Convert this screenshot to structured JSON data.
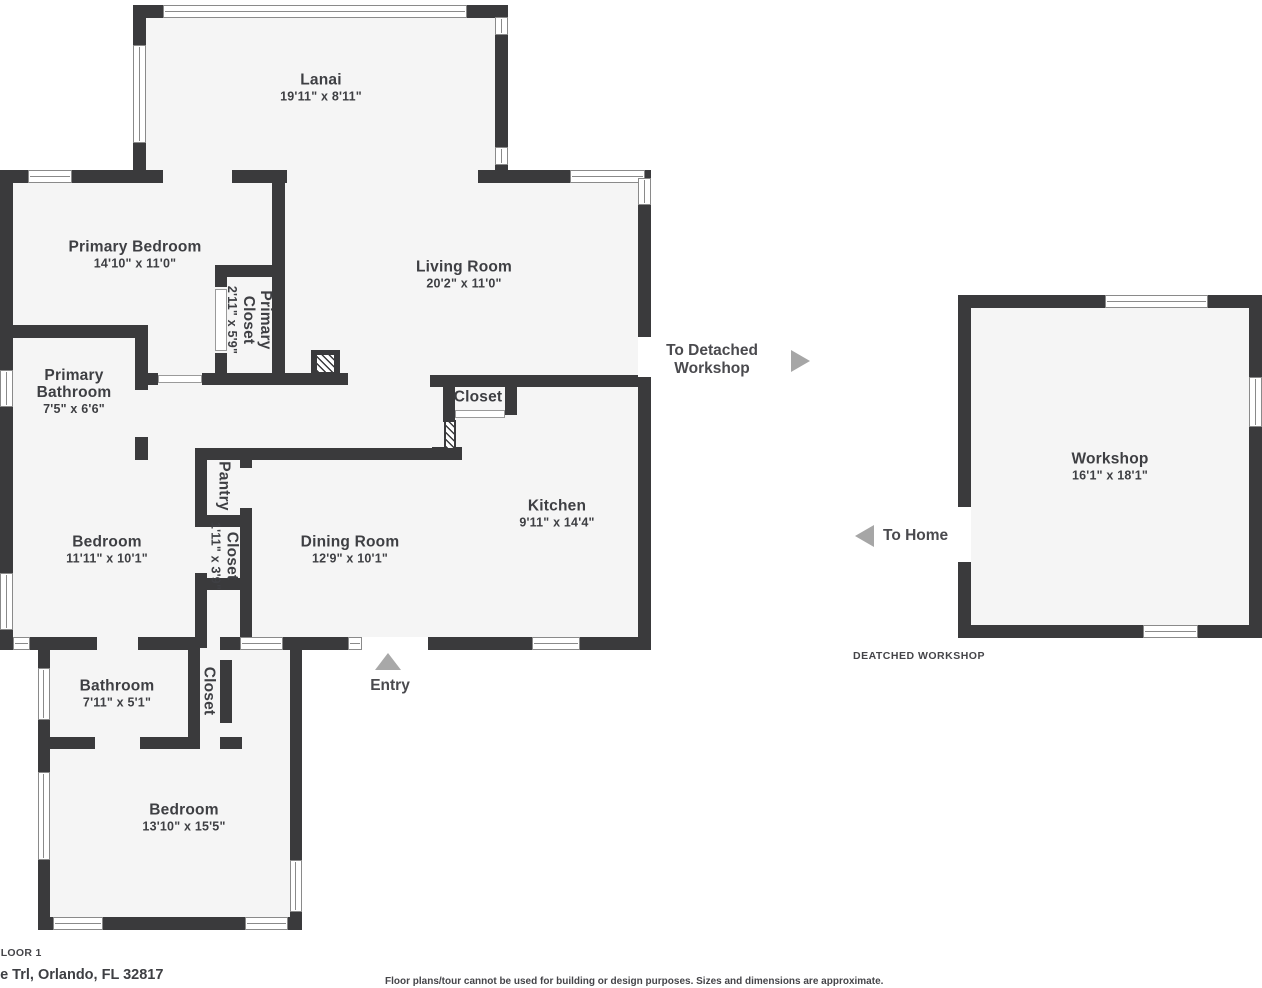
{
  "title": "Floor plan - Floor 1 with detached workshop",
  "colors": {
    "wall": "#3a3a3c",
    "floor": "#f5f5f5",
    "background": "#ffffff",
    "label_text": "#3e3f43",
    "arrow": "#a6a6a6",
    "window_border": "#8a8a8a"
  },
  "rooms": [
    {
      "id": "lanai",
      "name": "Lanai",
      "dims": "19'11\" x 8'11\"",
      "cx": 321,
      "cy": 88
    },
    {
      "id": "primary-bedroom",
      "name": "Primary Bedroom",
      "dims": "14'10\" x 11'0\"",
      "cx": 135,
      "cy": 255
    },
    {
      "id": "living-room",
      "name": "Living Room",
      "dims": "20'2\" x 11'0\"",
      "cx": 464,
      "cy": 275
    },
    {
      "id": "primary-closet",
      "name": "Primary Closet",
      "dims": "2'11\" x 5'9\"",
      "cx": 249,
      "cy": 320,
      "rotated": true,
      "wrap": 90
    },
    {
      "id": "primary-bathroom",
      "name": "Primary Bathroom",
      "dims": "7'5\" x 6'6\"",
      "cx": 74,
      "cy": 392,
      "wrap": 110
    },
    {
      "id": "kitchen-closet",
      "name": "Closet",
      "dims": "",
      "cx": 478,
      "cy": 397
    },
    {
      "id": "kitchen",
      "name": "Kitchen",
      "dims": "9'11\" x 14'4\"",
      "cx": 557,
      "cy": 514
    },
    {
      "id": "pantry",
      "name": "Pantry",
      "dims": "",
      "cx": 224,
      "cy": 486,
      "rotated": true
    },
    {
      "id": "hall-closet",
      "name": "Closet",
      "dims": "1'11\" x 3'9\"",
      "cx": 224,
      "cy": 556,
      "rotated": true
    },
    {
      "id": "bedroom",
      "name": "Bedroom",
      "dims": "11'11\" x 10'1\"",
      "cx": 107,
      "cy": 550
    },
    {
      "id": "dining-room",
      "name": "Dining Room",
      "dims": "12'9\" x 10'1\"",
      "cx": 350,
      "cy": 550
    },
    {
      "id": "bathroom",
      "name": "Bathroom",
      "dims": "7'11\" x 5'1\"",
      "cx": 117,
      "cy": 694
    },
    {
      "id": "lower-closet",
      "name": "Closet",
      "dims": "",
      "cx": 209,
      "cy": 691,
      "rotated": true
    },
    {
      "id": "lower-bedroom",
      "name": "Bedroom",
      "dims": "13'10\" x 15'5\"",
      "cx": 184,
      "cy": 818
    },
    {
      "id": "workshop",
      "name": "Workshop",
      "dims": "16'1\" x 18'1\"",
      "cx": 1110,
      "cy": 467
    }
  ],
  "annotations": {
    "to_detached_workshop": "To Detached Workshop",
    "to_home": "To Home",
    "entry": "Entry",
    "workshop_caption": "DEATCHED WORKSHOP",
    "floor_label": "FLOOR 1",
    "address": "ee Trl, Orlando, FL 32817",
    "disclaimer": "Floor plans/tour cannot be used for building or design purposes. Sizes and dimensions are approximate."
  },
  "plan": {
    "floors": [
      [
        133,
        5,
        375,
        178
      ],
      [
        0,
        170,
        651,
        480
      ],
      [
        38,
        648,
        264,
        282
      ],
      [
        958,
        295,
        304,
        343
      ]
    ],
    "walls": [
      [
        133,
        5,
        30,
        13
      ],
      [
        467,
        5,
        41,
        13
      ],
      [
        133,
        5,
        13,
        178
      ],
      [
        495,
        5,
        13,
        178
      ],
      [
        0,
        170,
        163,
        13
      ],
      [
        232,
        170,
        55,
        13
      ],
      [
        478,
        170,
        173,
        13
      ],
      [
        0,
        170,
        13,
        478
      ],
      [
        638,
        170,
        13,
        167
      ],
      [
        638,
        377,
        13,
        268
      ],
      [
        272,
        170,
        13,
        207
      ],
      [
        0,
        325,
        148,
        13
      ],
      [
        215,
        265,
        70,
        12
      ],
      [
        215,
        265,
        12,
        22
      ],
      [
        215,
        353,
        12,
        24
      ],
      [
        135,
        325,
        13,
        65
      ],
      [
        135,
        437,
        13,
        23
      ],
      [
        148,
        373,
        10,
        12
      ],
      [
        202,
        373,
        146,
        12
      ],
      [
        430,
        375,
        221,
        12
      ],
      [
        443,
        375,
        12,
        47
      ],
      [
        505,
        375,
        12,
        40
      ],
      [
        432,
        447,
        30,
        10
      ],
      [
        195,
        448,
        267,
        12
      ],
      [
        195,
        448,
        12,
        79
      ],
      [
        195,
        573,
        12,
        75
      ],
      [
        240,
        448,
        12,
        20
      ],
      [
        240,
        508,
        12,
        140
      ],
      [
        195,
        515,
        57,
        12
      ],
      [
        195,
        578,
        57,
        12
      ],
      [
        0,
        637,
        13,
        13
      ],
      [
        30,
        637,
        67,
        13
      ],
      [
        138,
        637,
        62,
        13
      ],
      [
        220,
        637,
        20,
        13
      ],
      [
        283,
        637,
        79,
        13
      ],
      [
        428,
        637,
        104,
        13
      ],
      [
        580,
        637,
        71,
        13
      ],
      [
        38,
        648,
        12,
        282
      ],
      [
        188,
        648,
        12,
        101
      ],
      [
        220,
        660,
        12,
        63
      ],
      [
        290,
        648,
        12,
        282
      ],
      [
        38,
        737,
        57,
        12
      ],
      [
        140,
        737,
        60,
        12
      ],
      [
        220,
        737,
        22,
        12
      ],
      [
        38,
        917,
        15,
        13
      ],
      [
        103,
        917,
        142,
        13
      ],
      [
        288,
        917,
        14,
        13
      ],
      [
        958,
        295,
        304,
        13
      ],
      [
        958,
        625,
        304,
        13
      ],
      [
        958,
        295,
        13,
        212
      ],
      [
        958,
        562,
        13,
        76
      ],
      [
        1249,
        295,
        13,
        343
      ]
    ],
    "windows": [
      [
        163,
        5,
        304,
        13
      ],
      [
        28,
        170,
        44,
        13
      ],
      [
        570,
        170,
        75,
        13
      ],
      [
        13,
        637,
        17,
        13
      ],
      [
        240,
        637,
        43,
        13
      ],
      [
        348,
        637,
        14,
        13
      ],
      [
        532,
        637,
        48,
        13
      ],
      [
        53,
        917,
        50,
        13
      ],
      [
        245,
        917,
        43,
        13
      ],
      [
        1105,
        295,
        103,
        13
      ],
      [
        1143,
        625,
        55,
        13
      ],
      [
        133,
        45,
        13,
        98
      ],
      [
        495,
        17,
        13,
        18
      ],
      [
        495,
        147,
        13,
        18
      ],
      [
        0,
        370,
        13,
        37
      ],
      [
        0,
        573,
        13,
        57
      ],
      [
        638,
        178,
        13,
        27
      ],
      [
        38,
        668,
        12,
        52
      ],
      [
        38,
        772,
        12,
        88
      ],
      [
        290,
        860,
        12,
        52
      ],
      [
        1249,
        377,
        13,
        50
      ]
    ],
    "door_gaps": [
      [
        362,
        637,
        66,
        13
      ],
      [
        638,
        337,
        13,
        40
      ],
      [
        958,
        507,
        13,
        55
      ]
    ],
    "door_panels": [
      [
        158,
        375,
        44,
        8
      ],
      [
        215,
        289,
        12,
        62
      ],
      [
        455,
        410,
        50,
        8
      ]
    ],
    "features": {
      "chimney": [
        311,
        350,
        29,
        27
      ],
      "water_heater": [
        444,
        420,
        12,
        30
      ]
    }
  }
}
